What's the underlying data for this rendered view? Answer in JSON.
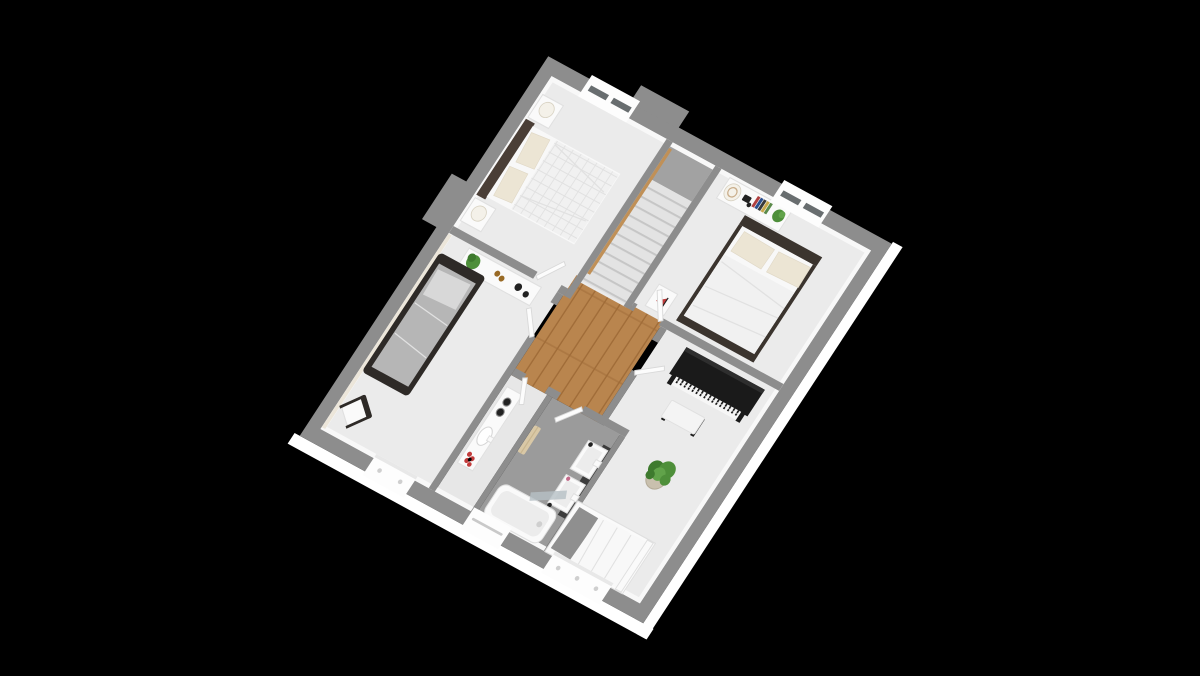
{
  "scene": {
    "title": "3D isometric floor-plan render of an upper storey on a black background",
    "floor_label": "Upper floor with central stair landing",
    "background": "#000000",
    "rooms": [
      {
        "id": "master-bedroom",
        "name": "Bedroom 1 – double bed, two nightstands with lamps, window",
        "windows": 1
      },
      {
        "id": "bedroom-2",
        "name": "Bedroom 2 – single bed with dark frame, wall desk with plant, chair, window",
        "windows": 1
      },
      {
        "id": "bedroom-3",
        "name": "Bedroom 3 – double bed, dresser with hat, camera, books and plant, nightstand",
        "windows": 1
      },
      {
        "id": "piano-room",
        "name": "Large room – upright piano with bench, potted plant, single bed, window",
        "windows": 1
      },
      {
        "id": "bathroom",
        "name": "Bathroom – twin washbasins, bathtub with glass screen, towel, window",
        "windows": 1
      },
      {
        "id": "wc",
        "name": "WC / vanity room – counter with sink and red flower bouquet",
        "windows": 0
      },
      {
        "id": "landing",
        "name": "Landing – wooden floor, staircase, five doorways",
        "windows": 0
      }
    ],
    "furniture": [
      "double-bed",
      "single-bed",
      "nightstand",
      "table-lamp",
      "desk-shelf",
      "dresser",
      "chair",
      "upright-piano",
      "piano-bench",
      "potted-plant",
      "bathtub",
      "glass-screen",
      "double-washbasin",
      "vanity-sink",
      "towel",
      "flower-bouquet",
      "books",
      "hat",
      "camera",
      "sail-ornament"
    ],
    "palette": {
      "bg": "#000000",
      "wall": "#8d8d8d",
      "wallInner": "#f8f8f8",
      "fascia": "#ffffff",
      "creamFace": "#ece6da",
      "floor": "#ebebeb",
      "bathFloor": "#9b9b9b",
      "wcFloor": "#e7e7e7",
      "wood": "#b9854e",
      "woodLine": "#a06c38",
      "stairTread": "#e3e3e3",
      "stairLine": "#c6c6c6",
      "stairVoid": "#a2a2a2",
      "handrail": "#c09057",
      "door": "#fcfcfc",
      "doorEdge": "#d9d9d9",
      "glassSlit": "#4e5356",
      "windowFrame": "#fdfdfd",
      "latch": "#cfcfcf",
      "bedWhite": "#f8f8f8",
      "duvet": "#f1f1f1",
      "duvetLine": "#e1e1e1",
      "mattress": "#b6b6b6",
      "pillowGray": "#d8d8d8",
      "pillowDark": "#8f8f8f",
      "pillowCream": "#ece5d4",
      "headboard": "#4a3e36",
      "bedFrame": "#2e2a27",
      "footboardDark": "#3b342e",
      "furnWhite": "#fafafa",
      "furnEdge": "#e0e0e0",
      "lampShade": "#f4f1e9",
      "lampEdge": "#d8d2c2",
      "piano": "#1a1a1a",
      "pianoSheen": "#2e2e2e",
      "keys": "#f6f6f6",
      "bench": "#f4f4f4",
      "plant": "#4e8f3a",
      "plantDark": "#3e7a2e",
      "plantLight": "#61a34a",
      "pot": "#c9c0ae",
      "potEdge": "#b5ac99",
      "glass": "#b7c0c5",
      "towel": "#d9c8a6",
      "red": "#c23b3b",
      "amber": "#996a25",
      "hat": "#dcc6a8",
      "hatEdge": "#c9ad8a",
      "itemDark": "#222222",
      "bookRed": "#b04040",
      "bookBlue": "#2b4f8e",
      "bookDark": "#3a3a3a",
      "bookYellow": "#c9a84c",
      "bookGreen": "#5a8a4a",
      "counterDark": "#3c3c3c",
      "tubInner": "#ececec"
    }
  }
}
